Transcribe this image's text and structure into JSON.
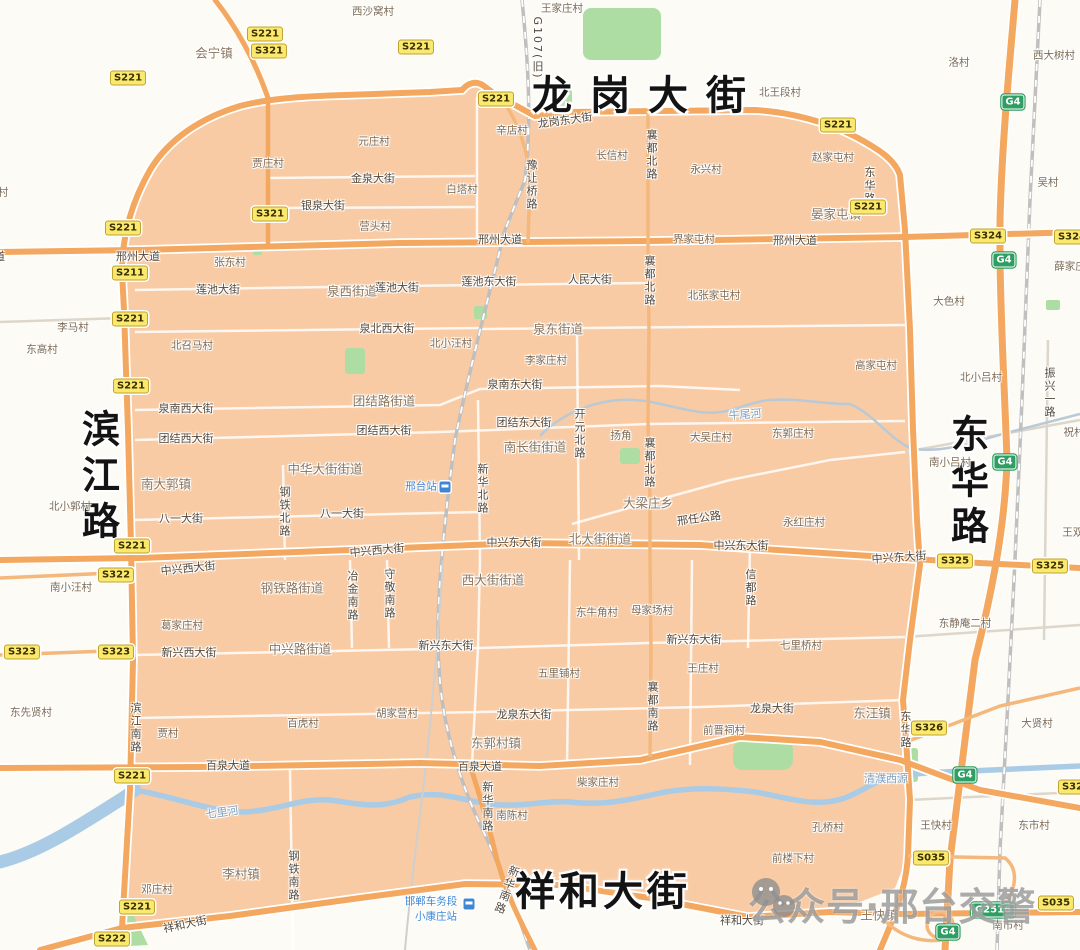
{
  "watermark": {
    "text": "公众号·邢台交警"
  },
  "region": {
    "fill": "#f8cba4",
    "road_color": "#f3a75f"
  },
  "labels": [
    {
      "t": "龙岗大街",
      "x": 648,
      "y": 92,
      "c": "big",
      "s": 18
    },
    {
      "t": "祥和大街",
      "x": 603,
      "y": 888,
      "c": "big",
      "s": 4
    },
    {
      "t": "滨江路",
      "x": 98,
      "y": 478,
      "c": "bigv",
      "s": 8
    },
    {
      "t": "东华路",
      "x": 967,
      "y": 483,
      "c": "bigv",
      "s": 8
    },
    {
      "t": "会宁镇",
      "x": 214,
      "y": 52,
      "c": "town"
    },
    {
      "t": "晏家屯镇",
      "x": 836,
      "y": 213,
      "c": "town"
    },
    {
      "t": "泉西街道",
      "x": 352,
      "y": 290,
      "c": "town"
    },
    {
      "t": "泉东街道",
      "x": 558,
      "y": 328,
      "c": "town"
    },
    {
      "t": "团结路街道",
      "x": 384,
      "y": 400,
      "c": "town"
    },
    {
      "t": "中华大街街道",
      "x": 325,
      "y": 468,
      "c": "town"
    },
    {
      "t": "南长街街道",
      "x": 535,
      "y": 446,
      "c": "town"
    },
    {
      "t": "南大郭镇",
      "x": 166,
      "y": 483,
      "c": "town"
    },
    {
      "t": "大梁庄乡",
      "x": 648,
      "y": 502,
      "c": "town"
    },
    {
      "t": "北大街街道",
      "x": 600,
      "y": 538,
      "c": "town"
    },
    {
      "t": "西大街街道",
      "x": 493,
      "y": 579,
      "c": "town"
    },
    {
      "t": "钢铁路街道",
      "x": 292,
      "y": 587,
      "c": "town"
    },
    {
      "t": "中兴路街道",
      "x": 300,
      "y": 648,
      "c": "town"
    },
    {
      "t": "东郭村镇",
      "x": 496,
      "y": 742,
      "c": "town"
    },
    {
      "t": "东汪镇",
      "x": 872,
      "y": 712,
      "c": "town"
    },
    {
      "t": "李村镇",
      "x": 241,
      "y": 873,
      "c": "town"
    },
    {
      "t": "王快镇",
      "x": 879,
      "y": 914,
      "c": "town"
    },
    {
      "t": "西沙窝村",
      "x": 373,
      "y": 11,
      "c": "village"
    },
    {
      "t": "王家庄村",
      "x": 562,
      "y": 8,
      "c": "village"
    },
    {
      "t": "洛村",
      "x": 959,
      "y": 62,
      "c": "village"
    },
    {
      "t": "西大树村",
      "x": 1054,
      "y": 55,
      "c": "village"
    },
    {
      "t": "北王段村",
      "x": 780,
      "y": 92,
      "c": "village"
    },
    {
      "t": "辛店村",
      "x": 512,
      "y": 130,
      "c": "village"
    },
    {
      "t": "元庄村",
      "x": 374,
      "y": 141,
      "c": "village"
    },
    {
      "t": "贾庄村",
      "x": 268,
      "y": 163,
      "c": "village"
    },
    {
      "t": "白塔村",
      "x": 462,
      "y": 189,
      "c": "village"
    },
    {
      "t": "营头村",
      "x": 375,
      "y": 226,
      "c": "village"
    },
    {
      "t": "长信村",
      "x": 612,
      "y": 155,
      "c": "village"
    },
    {
      "t": "永兴村",
      "x": 706,
      "y": 169,
      "c": "village"
    },
    {
      "t": "赵家屯村",
      "x": 833,
      "y": 157,
      "c": "village"
    },
    {
      "t": "吴村",
      "x": 1048,
      "y": 182,
      "c": "village"
    },
    {
      "t": "村",
      "x": 3,
      "y": 192,
      "c": "village"
    },
    {
      "t": "界家屯村",
      "x": 694,
      "y": 239,
      "c": "village"
    },
    {
      "t": "张东村",
      "x": 230,
      "y": 262,
      "c": "village"
    },
    {
      "t": "北张家屯村",
      "x": 714,
      "y": 295,
      "c": "village"
    },
    {
      "t": "薛家庄",
      "x": 1070,
      "y": 266,
      "c": "village"
    },
    {
      "t": "李马村",
      "x": 73,
      "y": 327,
      "c": "village"
    },
    {
      "t": "东高村",
      "x": 42,
      "y": 349,
      "c": "village"
    },
    {
      "t": "北召马村",
      "x": 192,
      "y": 345,
      "c": "village"
    },
    {
      "t": "北小汪村",
      "x": 451,
      "y": 343,
      "c": "village"
    },
    {
      "t": "李家庄村",
      "x": 546,
      "y": 360,
      "c": "village"
    },
    {
      "t": "大色村",
      "x": 949,
      "y": 301,
      "c": "village"
    },
    {
      "t": "高家屯村",
      "x": 876,
      "y": 365,
      "c": "village"
    },
    {
      "t": "北小吕村",
      "x": 981,
      "y": 377,
      "c": "village"
    },
    {
      "t": "祝村",
      "x": 1074,
      "y": 432,
      "c": "village"
    },
    {
      "t": "南小吕村",
      "x": 950,
      "y": 462,
      "c": "village"
    },
    {
      "t": "王双村",
      "x": 1078,
      "y": 532,
      "c": "village"
    },
    {
      "t": "北小郭村",
      "x": 70,
      "y": 506,
      "c": "village"
    },
    {
      "t": "扬角",
      "x": 621,
      "y": 435,
      "c": "village"
    },
    {
      "t": "大吴庄村",
      "x": 711,
      "y": 437,
      "c": "village"
    },
    {
      "t": "东郭庄村",
      "x": 793,
      "y": 433,
      "c": "village"
    },
    {
      "t": "永红庄村",
      "x": 804,
      "y": 522,
      "c": "village"
    },
    {
      "t": "南小汪村",
      "x": 71,
      "y": 587,
      "c": "village"
    },
    {
      "t": "葛家庄村",
      "x": 182,
      "y": 625,
      "c": "village"
    },
    {
      "t": "东先贤村",
      "x": 31,
      "y": 712,
      "c": "village"
    },
    {
      "t": "贾村",
      "x": 168,
      "y": 733,
      "c": "village"
    },
    {
      "t": "百虎村",
      "x": 303,
      "y": 723,
      "c": "village"
    },
    {
      "t": "胡家营村",
      "x": 397,
      "y": 713,
      "c": "village"
    },
    {
      "t": "东牛角村",
      "x": 597,
      "y": 612,
      "c": "village"
    },
    {
      "t": "母家场村",
      "x": 652,
      "y": 610,
      "c": "village"
    },
    {
      "t": "五里铺村",
      "x": 559,
      "y": 673,
      "c": "village"
    },
    {
      "t": "王庄村",
      "x": 703,
      "y": 668,
      "c": "village"
    },
    {
      "t": "七里桥村",
      "x": 801,
      "y": 645,
      "c": "village"
    },
    {
      "t": "东静庵二村",
      "x": 965,
      "y": 623,
      "c": "village"
    },
    {
      "t": "大贤村",
      "x": 1037,
      "y": 723,
      "c": "village"
    },
    {
      "t": "前晋祠村",
      "x": 724,
      "y": 730,
      "c": "village"
    },
    {
      "t": "柴家庄村",
      "x": 598,
      "y": 782,
      "c": "village"
    },
    {
      "t": "南陈村",
      "x": 512,
      "y": 815,
      "c": "village"
    },
    {
      "t": "孔桥村",
      "x": 828,
      "y": 827,
      "c": "village"
    },
    {
      "t": "前楼下村",
      "x": 793,
      "y": 858,
      "c": "village"
    },
    {
      "t": "王快村",
      "x": 936,
      "y": 825,
      "c": "village"
    },
    {
      "t": "东市村",
      "x": 1034,
      "y": 825,
      "c": "village"
    },
    {
      "t": "南市村",
      "x": 1008,
      "y": 925,
      "c": "village"
    },
    {
      "t": "邓庄村",
      "x": 157,
      "y": 889,
      "c": "village"
    },
    {
      "t": "龙岗东大街",
      "x": 565,
      "y": 120,
      "c": "street",
      "r": -8
    },
    {
      "t": "金泉大街",
      "x": 373,
      "y": 178,
      "c": "street"
    },
    {
      "t": "银泉大街",
      "x": 323,
      "y": 205,
      "c": "street"
    },
    {
      "t": "大道",
      "x": -6,
      "y": 256,
      "c": "street"
    },
    {
      "t": "邢州大道",
      "x": 138,
      "y": 256,
      "c": "street"
    },
    {
      "t": "邢州大道",
      "x": 500,
      "y": 239,
      "c": "street"
    },
    {
      "t": "邢州大道",
      "x": 795,
      "y": 240,
      "c": "street"
    },
    {
      "t": "莲池大街",
      "x": 218,
      "y": 289,
      "c": "street"
    },
    {
      "t": "莲池大街",
      "x": 397,
      "y": 287,
      "c": "street"
    },
    {
      "t": "莲池东大街",
      "x": 489,
      "y": 281,
      "c": "street"
    },
    {
      "t": "人民大街",
      "x": 590,
      "y": 279,
      "c": "street"
    },
    {
      "t": "泉北西大街",
      "x": 387,
      "y": 328,
      "c": "street"
    },
    {
      "t": "泉南西大街",
      "x": 186,
      "y": 408,
      "c": "street"
    },
    {
      "t": "泉南东大街",
      "x": 515,
      "y": 384,
      "c": "street"
    },
    {
      "t": "团结西大街",
      "x": 186,
      "y": 438,
      "c": "street"
    },
    {
      "t": "团结西大街",
      "x": 384,
      "y": 430,
      "c": "street"
    },
    {
      "t": "团结东大街",
      "x": 524,
      "y": 422,
      "c": "street"
    },
    {
      "t": "八一大街",
      "x": 181,
      "y": 518,
      "c": "street"
    },
    {
      "t": "八一大街",
      "x": 342,
      "y": 513,
      "c": "street"
    },
    {
      "t": "中兴西大街",
      "x": 188,
      "y": 568,
      "c": "street",
      "r": -6
    },
    {
      "t": "中兴西大街",
      "x": 377,
      "y": 550,
      "c": "street",
      "r": -5
    },
    {
      "t": "中兴东大街",
      "x": 514,
      "y": 542,
      "c": "street"
    },
    {
      "t": "中兴东大街",
      "x": 741,
      "y": 545,
      "c": "street"
    },
    {
      "t": "中兴东大街",
      "x": 899,
      "y": 557,
      "c": "street",
      "r": -4
    },
    {
      "t": "新兴西大街",
      "x": 189,
      "y": 652,
      "c": "street"
    },
    {
      "t": "新兴东大街",
      "x": 446,
      "y": 645,
      "c": "street"
    },
    {
      "t": "新兴东大街",
      "x": 694,
      "y": 639,
      "c": "street"
    },
    {
      "t": "龙泉东大街",
      "x": 524,
      "y": 714,
      "c": "street"
    },
    {
      "t": "龙泉大街",
      "x": 772,
      "y": 708,
      "c": "street"
    },
    {
      "t": "百泉大道",
      "x": 228,
      "y": 765,
      "c": "street"
    },
    {
      "t": "百泉大道",
      "x": 480,
      "y": 766,
      "c": "street"
    },
    {
      "t": "祥和大街",
      "x": 185,
      "y": 924,
      "c": "street",
      "r": -12
    },
    {
      "t": "祥和大街",
      "x": 742,
      "y": 920,
      "c": "street"
    },
    {
      "t": "邢任公路",
      "x": 699,
      "y": 518,
      "c": "street",
      "r": -8
    },
    {
      "t": "G107(旧)",
      "x": 537,
      "y": 48,
      "c": "streetv"
    },
    {
      "t": "豫让桥路",
      "x": 531,
      "y": 185,
      "c": "streetv"
    },
    {
      "t": "襄都北路",
      "x": 651,
      "y": 155,
      "c": "streetv"
    },
    {
      "t": "襄都北路",
      "x": 649,
      "y": 281,
      "c": "streetv"
    },
    {
      "t": "襄都北路",
      "x": 649,
      "y": 463,
      "c": "streetv"
    },
    {
      "t": "开元北路",
      "x": 579,
      "y": 434,
      "c": "streetv"
    },
    {
      "t": "新华北路",
      "x": 482,
      "y": 489,
      "c": "streetv"
    },
    {
      "t": "钢铁北路",
      "x": 284,
      "y": 512,
      "c": "streetv"
    },
    {
      "t": "冶金南路",
      "x": 352,
      "y": 596,
      "c": "streetv"
    },
    {
      "t": "守敬南路",
      "x": 389,
      "y": 594,
      "c": "streetv"
    },
    {
      "t": "襄都南路",
      "x": 652,
      "y": 707,
      "c": "streetv"
    },
    {
      "t": "信都路",
      "x": 750,
      "y": 588,
      "c": "streetv"
    },
    {
      "t": "滨江南路",
      "x": 135,
      "y": 728,
      "c": "streetv"
    },
    {
      "t": "钢铁南路",
      "x": 293,
      "y": 876,
      "c": "streetv"
    },
    {
      "t": "新华南路",
      "x": 487,
      "y": 807,
      "c": "streetv"
    },
    {
      "t": "新华南路",
      "x": 506,
      "y": 890,
      "c": "streetv",
      "r": 20
    },
    {
      "t": "东华路",
      "x": 869,
      "y": 186,
      "c": "streetv"
    },
    {
      "t": "东华路",
      "x": 905,
      "y": 730,
      "c": "streetv"
    },
    {
      "t": "振兴一路",
      "x": 1049,
      "y": 393,
      "c": "streetv"
    },
    {
      "t": "七里河",
      "x": 222,
      "y": 812,
      "c": "river",
      "r": -8
    },
    {
      "t": "清濮西源",
      "x": 886,
      "y": 778,
      "c": "river"
    },
    {
      "t": "牛尾河",
      "x": 745,
      "y": 414,
      "c": "river",
      "r": -4
    },
    {
      "t": "邢台站",
      "x": 421,
      "y": 486,
      "c": "station"
    },
    {
      "t": "邯郸车务段",
      "x": 431,
      "y": 901,
      "c": "station"
    },
    {
      "t": "小康庄站",
      "x": 436,
      "y": 916,
      "c": "station"
    }
  ],
  "badges": [
    {
      "t": "S221",
      "x": 265,
      "y": 34,
      "k": "s"
    },
    {
      "t": "S321",
      "x": 269,
      "y": 51,
      "k": "s"
    },
    {
      "t": "S221",
      "x": 416,
      "y": 47,
      "k": "s"
    },
    {
      "t": "S221",
      "x": 128,
      "y": 78,
      "k": "s"
    },
    {
      "t": "S221",
      "x": 496,
      "y": 99,
      "k": "s"
    },
    {
      "t": "S221",
      "x": 838,
      "y": 125,
      "k": "s"
    },
    {
      "t": "S221",
      "x": 868,
      "y": 207,
      "k": "s"
    },
    {
      "t": "S321",
      "x": 270,
      "y": 214,
      "k": "s"
    },
    {
      "t": "S221",
      "x": 123,
      "y": 228,
      "k": "s"
    },
    {
      "t": "S211",
      "x": 130,
      "y": 273,
      "k": "s"
    },
    {
      "t": "S324",
      "x": 988,
      "y": 236,
      "k": "s"
    },
    {
      "t": "S324",
      "x": 1072,
      "y": 237,
      "k": "s"
    },
    {
      "t": "S221",
      "x": 130,
      "y": 319,
      "k": "s"
    },
    {
      "t": "S221",
      "x": 131,
      "y": 386,
      "k": "s"
    },
    {
      "t": "S221",
      "x": 132,
      "y": 546,
      "k": "s"
    },
    {
      "t": "S322",
      "x": 116,
      "y": 575,
      "k": "s"
    },
    {
      "t": "S323",
      "x": 22,
      "y": 652,
      "k": "s"
    },
    {
      "t": "S323",
      "x": 116,
      "y": 652,
      "k": "s"
    },
    {
      "t": "S325",
      "x": 955,
      "y": 561,
      "k": "s"
    },
    {
      "t": "S325",
      "x": 1050,
      "y": 566,
      "k": "s"
    },
    {
      "t": "S326",
      "x": 929,
      "y": 728,
      "k": "s"
    },
    {
      "t": "S221",
      "x": 132,
      "y": 776,
      "k": "s"
    },
    {
      "t": "S325",
      "x": 1076,
      "y": 787,
      "k": "s"
    },
    {
      "t": "S035",
      "x": 931,
      "y": 858,
      "k": "s"
    },
    {
      "t": "S035",
      "x": 1056,
      "y": 903,
      "k": "s"
    },
    {
      "t": "S221",
      "x": 137,
      "y": 907,
      "k": "s"
    },
    {
      "t": "S222",
      "x": 112,
      "y": 939,
      "k": "s"
    },
    {
      "t": "G4",
      "x": 1013,
      "y": 102,
      "k": "g"
    },
    {
      "t": "G4",
      "x": 1004,
      "y": 260,
      "k": "g"
    },
    {
      "t": "G4",
      "x": 1005,
      "y": 462,
      "k": "g"
    },
    {
      "t": "G4",
      "x": 965,
      "y": 775,
      "k": "g"
    },
    {
      "t": "G4",
      "x": 948,
      "y": 932,
      "k": "g"
    },
    {
      "t": "G2516",
      "x": 993,
      "y": 910,
      "k": "g"
    }
  ],
  "station_icons": [
    {
      "x": 445,
      "y": 487
    },
    {
      "x": 469,
      "y": 904
    }
  ]
}
